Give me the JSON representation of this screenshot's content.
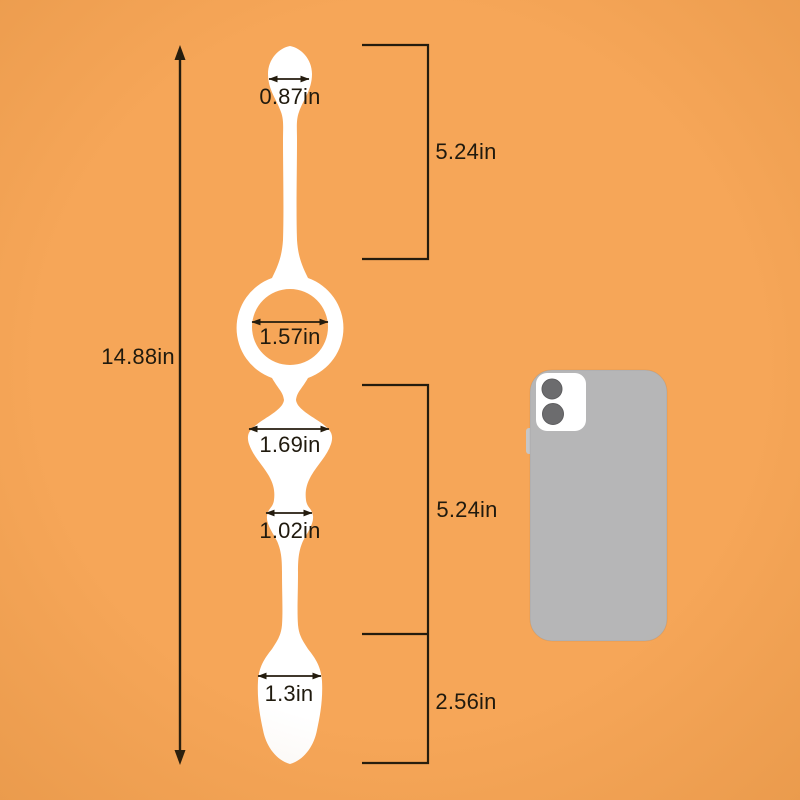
{
  "scene": {
    "background_color": "#F6A658",
    "product_color": "#FFFFFF",
    "line_color": "#241C0E",
    "phone_body_color": "#B6B6B7",
    "phone_camera_plate_color": "#FFFFFF",
    "phone_lens_color": "#6C6C6E"
  },
  "measurements": {
    "total_length": "14.88in",
    "top_bead_width": "0.87in",
    "upper_section_length": "5.24in",
    "ring_inner_diameter": "1.57in",
    "large_bead_width": "1.69in",
    "bulge_width": "1.02in",
    "mid_section_length": "5.24in",
    "bottom_bead_width": "1.3in",
    "tail_section_length": "2.56in"
  }
}
